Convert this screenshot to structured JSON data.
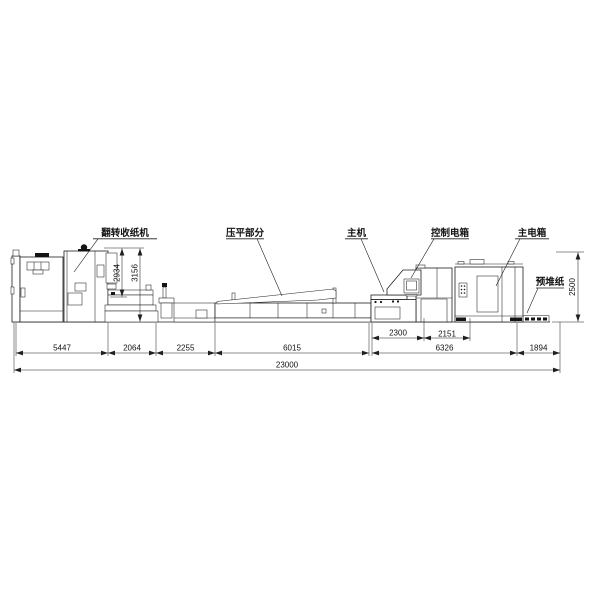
{
  "drawing": {
    "labels": {
      "flip_stacker": "翻转收纸机",
      "flattening": "压平部分",
      "main_machine": "主机",
      "control_box": "控制电箱",
      "main_electric_box": "主电箱",
      "prestack_paper": "预堆纸"
    },
    "dimensions": {
      "vertical": [
        "2934",
        "3156",
        "2500"
      ],
      "upper_row": [
        "2300",
        "2151"
      ],
      "main_row": [
        "5447",
        "2064",
        "2255",
        "6015",
        "6326",
        "1894"
      ],
      "total": "23000"
    },
    "colors": {
      "line": "#1f1f1f",
      "background": "#ffffff"
    }
  }
}
